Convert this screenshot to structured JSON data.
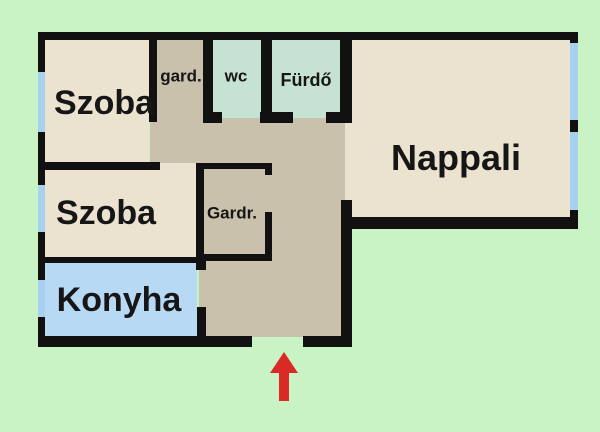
{
  "title": "Apartment floor plan",
  "colors": {
    "background": "#c9f2c5",
    "wall": "#111111",
    "room": "#ece2d0",
    "hall": "#c9c1ab",
    "wet": "#c6e2d2",
    "kitchen": "#b7d9f4",
    "window": "#a6d2ef",
    "text": "#161616",
    "arrow": "#d92a25"
  },
  "rooms": {
    "szoba1": {
      "label": "Szoba",
      "type": "bedroom"
    },
    "szoba2": {
      "label": "Szoba",
      "type": "bedroom"
    },
    "konyha": {
      "label": "Konyha",
      "type": "kitchen"
    },
    "nappali": {
      "label": "Nappali",
      "type": "living-room"
    },
    "gard": {
      "label": "gard.",
      "type": "wardrobe"
    },
    "wc": {
      "label": "wc",
      "type": "toilet"
    },
    "furdo": {
      "label": "Fürdő",
      "type": "bathroom"
    },
    "gardrob": {
      "label": "Gardr.",
      "type": "walk-in-closet"
    }
  },
  "entrance": {
    "indicator": "red arrow pointing up into bottom doorway"
  }
}
